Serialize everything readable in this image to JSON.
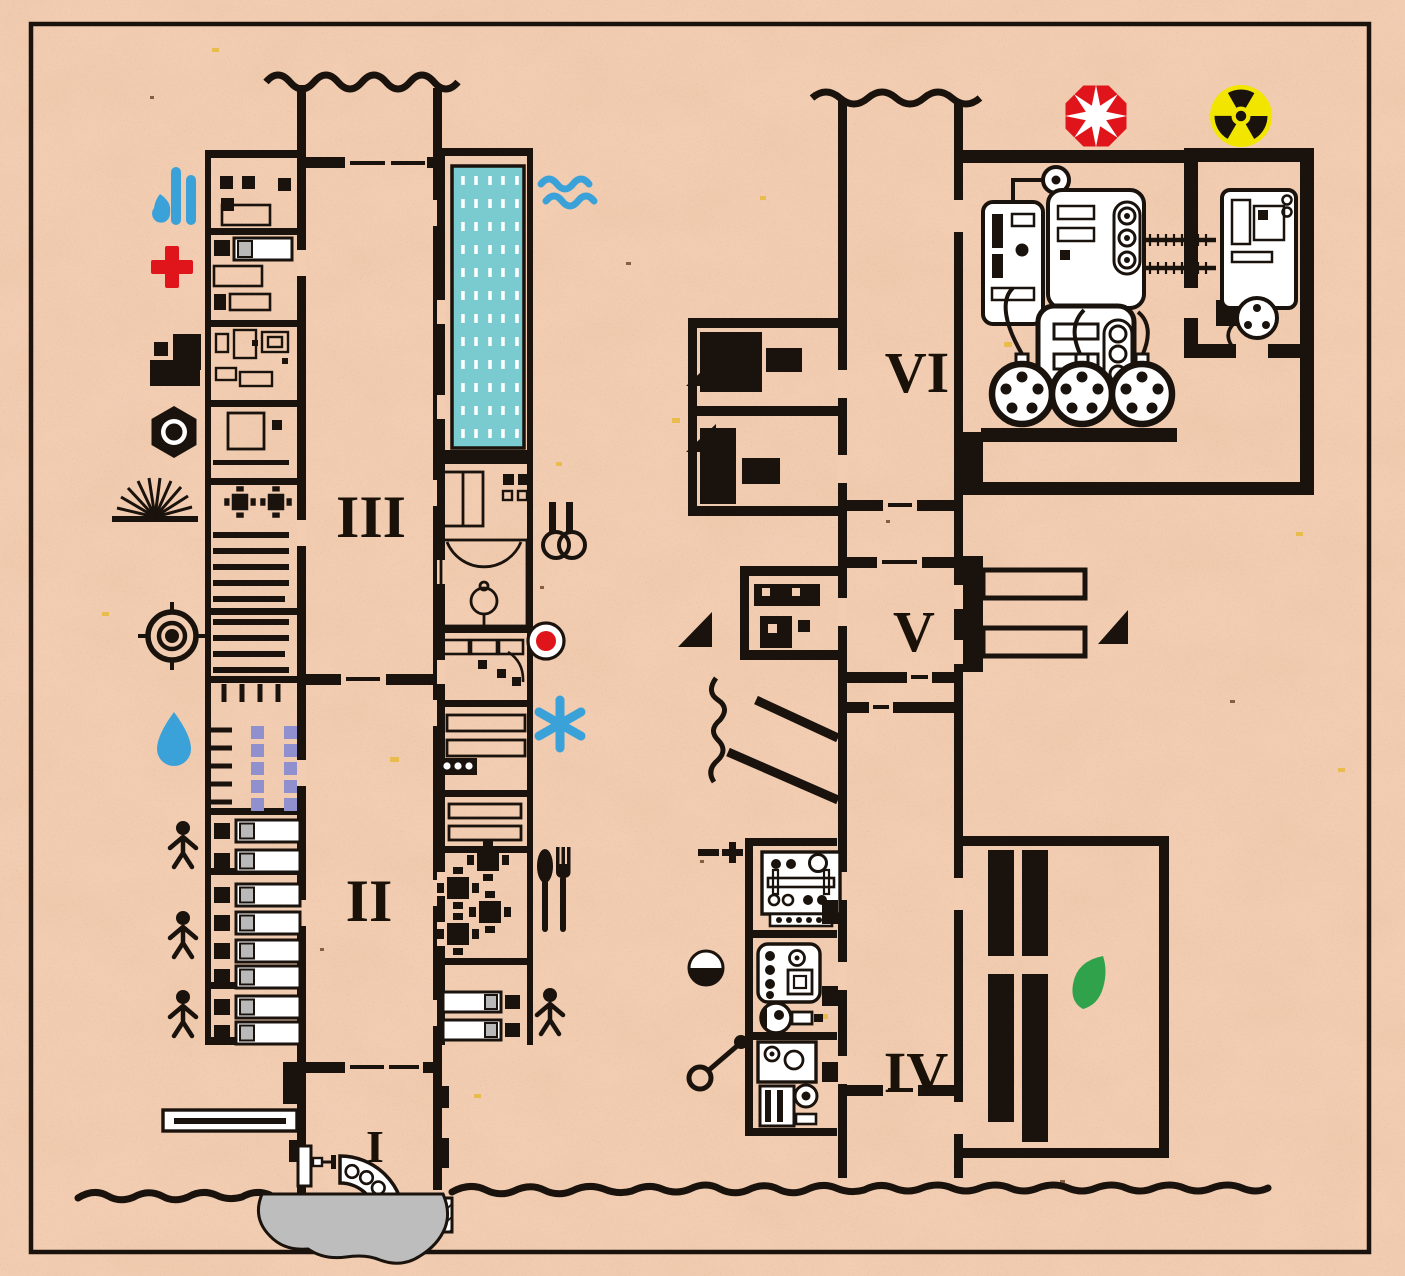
{
  "title": "Underground bunker sectional floor plan on recycled paper",
  "palette": {
    "paper": "#f2cdb2",
    "ink": "#1a120c",
    "pool_teal": "#79cbcf",
    "water_blue": "#3ba2d9",
    "alert_red": "#e0151b",
    "radiation_yellow": "#f2e600",
    "leaf_green": "#2fa24b",
    "chair_purple": "#9190cf",
    "pond_gray": "#bdbdbd",
    "pillow_gray": "#b9b9b9"
  },
  "levels": [
    {
      "numeral": "I",
      "name": "entrance-level"
    },
    {
      "numeral": "II",
      "name": "dormitory-level"
    },
    {
      "numeral": "III",
      "name": "recreation-level"
    },
    {
      "numeral": "IV",
      "name": "plant-level"
    },
    {
      "numeral": "V",
      "name": "stores-level"
    },
    {
      "numeral": "VI",
      "name": "reactor-level"
    }
  ],
  "legend_icons": [
    "water-supply-icon",
    "medical-cross-icon",
    "storage-blocks-icon",
    "nut-icon",
    "ventilation-rays-icon",
    "target-icon",
    "water-drop-icon",
    "person-icon",
    "pool-waves-icon",
    "gymnast-rings-icon",
    "firing-point-icon",
    "snowflake-icon",
    "cutlery-icon",
    "blast-star-icon",
    "radiation-icon",
    "battery-icon",
    "day-night-icon",
    "key-icon",
    "leaf-icon",
    "direction-triangle-icon"
  ]
}
